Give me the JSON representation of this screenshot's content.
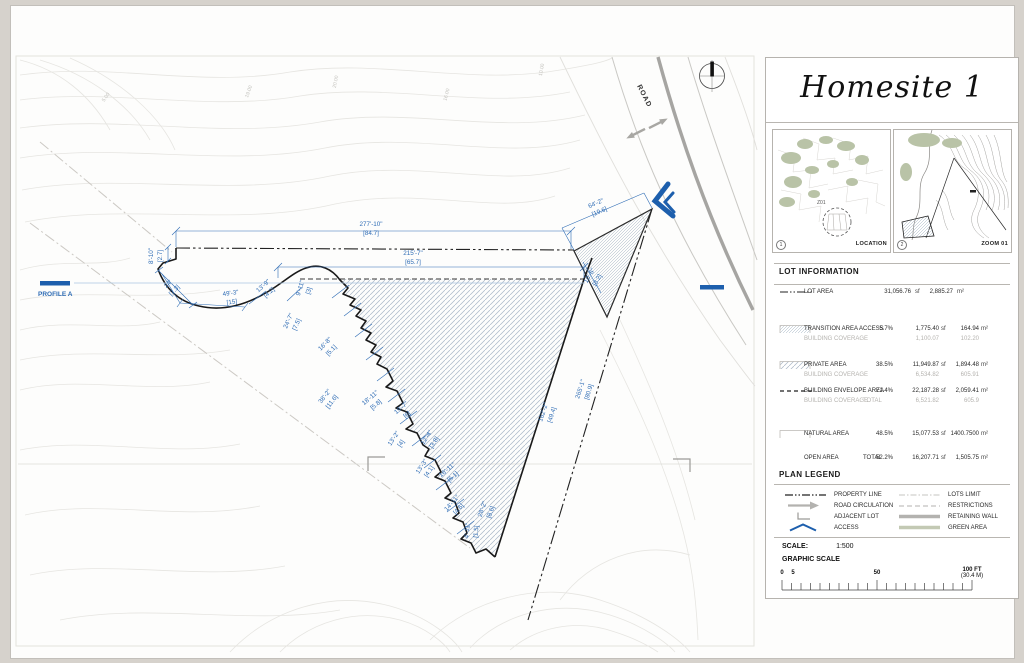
{
  "title_panel": {
    "title": "Homesite 1"
  },
  "maps": {
    "location": {
      "number": "1",
      "label": "LOCATION",
      "tag": "Z01"
    },
    "zoom": {
      "number": "2",
      "label": "ZOOM 01"
    }
  },
  "lot_information": {
    "header": "LOT INFORMATION",
    "unit_sf": "sf",
    "unit_m2": "m²",
    "rows": {
      "lot_area": {
        "label": "LOT AREA",
        "sf": "31,056.76",
        "m2": "2,885.27"
      },
      "transition": {
        "label": "TRANSITION AREA ACCESS",
        "pct": "5.7%",
        "sf": "1,775.40",
        "m2": "164.94",
        "sub": "BUILDING COVERAGE",
        "sub_sf": "1,100.07",
        "sub_m2": "102.20"
      },
      "private": {
        "label": "PRIVATE AREA",
        "pct": "38.5%",
        "sf": "11,949.87",
        "m2": "1,894.48",
        "sub": "BUILDING COVERAGE",
        "sub_sf": "6,534.82",
        "sub_m2": "605.91"
      },
      "envelope": {
        "label": "BUILDING ENVELOPE AREA",
        "pct": "71.4%",
        "sf": "22,187.28",
        "m2": "2,059.41",
        "sub": "BUILDING COVERAGE",
        "sub2": "TOTAL",
        "sub_sf": "6,521.82",
        "sub_m2": "605.9"
      },
      "natural": {
        "label": "NATURAL AREA",
        "pct": "48.5%",
        "sf": "15,077.53",
        "m2": "1400.7500"
      },
      "open": {
        "label": "OPEN AREA",
        "total": "TOTAL",
        "pct": "52.2%",
        "sf": "16,207.71",
        "m2": "1,505.75"
      }
    }
  },
  "plan_legend": {
    "header": "PLAN LEGEND",
    "items_left": [
      {
        "label": "PROPERTY LINE"
      },
      {
        "label": "ROAD CIRCULATION"
      },
      {
        "label": "ADJACENT LOT"
      },
      {
        "label": "ACCESS"
      }
    ],
    "items_right": [
      {
        "label": "LOTS LIMIT"
      },
      {
        "label": "RESTRICTIONS"
      },
      {
        "label": "RETAINING WALL"
      },
      {
        "label": "GREEN AREA"
      }
    ]
  },
  "scale_block": {
    "scale_label": "SCALE:",
    "scale_value": "1:500",
    "graphic_label": "GRAPHIC SCALE",
    "tick_0": "0",
    "tick_5": "5",
    "tick_50": "50",
    "tick_100": "100 FT",
    "tick_100_m": "(30.4 M)"
  },
  "drawing": {
    "road_label": "ROAD",
    "profile_label": "PROFILE A",
    "dims": [
      {
        "ft": "277'-10\"",
        "m": "[84.7]"
      },
      {
        "ft": "215'-7\"",
        "m": "[65.7]"
      },
      {
        "ft": "64'-2\"",
        "m": "[19.6]"
      },
      {
        "ft": "8'-10\"",
        "m": "[2.7]"
      },
      {
        "ft": "24'",
        "m": "[7.3]"
      },
      {
        "ft": "49'-3\"",
        "m": "[15]"
      },
      {
        "ft": "13'-9\"",
        "m": "[4.2]"
      },
      {
        "ft": "9'-11\"",
        "m": "[3]"
      },
      {
        "ft": "24'-7\"",
        "m": "[7.5]"
      },
      {
        "ft": "16'-8\"",
        "m": "[5.1]"
      },
      {
        "ft": "38'-2\"",
        "m": "[11.6]"
      },
      {
        "ft": "18'-11\"",
        "m": "[5.8]"
      },
      {
        "ft": "19'-7\"",
        "m": "[6]"
      },
      {
        "ft": "13'-2\"",
        "m": "[4]"
      },
      {
        "ft": "12'-4\"",
        "m": "[3.8]"
      },
      {
        "ft": "13'-3\"",
        "m": "[4.1]"
      },
      {
        "ft": "16'-11\"",
        "m": "[5.1]"
      },
      {
        "ft": "14'-11\"",
        "m": "[4.6]"
      },
      {
        "ft": "28'-2\"",
        "m": "[8.6]"
      },
      {
        "ft": "4'-11\"",
        "m": "[1.5]"
      },
      {
        "ft": "162'-2\"",
        "m": "[49.4]"
      },
      {
        "ft": "265'-1\"",
        "m": "[80.9]"
      },
      {
        "ft": "10'-6\"",
        "m": "[3.2]"
      }
    ],
    "contour_labels": [
      "5.00",
      "19.00",
      "20.00",
      "16.00",
      "10.00"
    ]
  },
  "colors": {
    "dimension_blue": "#2e6cb5",
    "access_blue": "#1d5fad",
    "hatch_blue_gray": "#aab6c6",
    "green_area": "#c3c9b4",
    "road_gray": "#a6a5a2"
  }
}
